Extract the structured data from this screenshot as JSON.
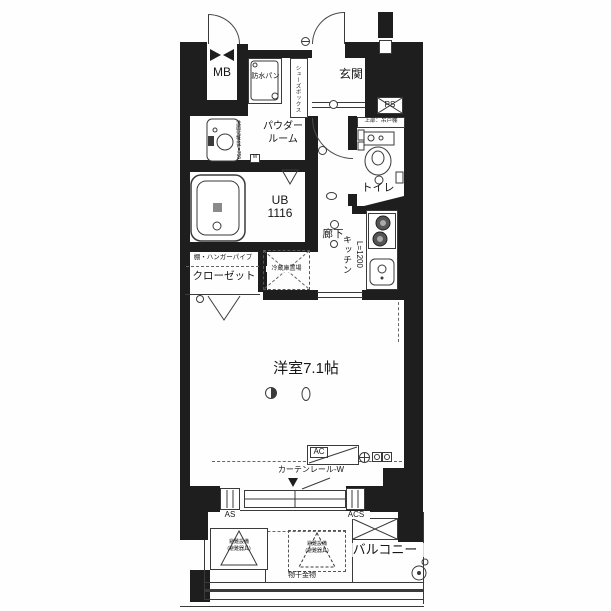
{
  "labels": {
    "mb": "MB",
    "waterproof_pan": "防水パン",
    "shoe_box": "シューズボックス",
    "entrance": "玄関",
    "ps": "PS",
    "powder_room_1": "パウダー",
    "powder_room_2": "ルーム",
    "vanity": "洗面化粧台L=750",
    "mixing_valve": "M",
    "unit_bath_1": "UB",
    "unit_bath_2": "1116",
    "hallway": "廊下",
    "toilet": "トイレ",
    "toilet_shelf": "上部：吊戸棚",
    "kitchen": "キッチン",
    "kitchen_size": "L=1200",
    "closet": "クローゼット",
    "closet_shelf": "棚・ハンガーパイプ",
    "fridge_space": "冷蔵庫置場",
    "main_room": "洋室7.1帖",
    "ac": "AC",
    "curtain_rail": "カーテンレール-W",
    "as": "AS",
    "acs": "ACS",
    "balcony": "バルコニー",
    "laundry_hardware": "物干金物",
    "evac_1": "避難設備",
    "evac_2": "(避難器具)"
  },
  "colors": {
    "wall": "#1e1e1e",
    "line": "#3a3a3a",
    "paper": "#ffffff"
  }
}
